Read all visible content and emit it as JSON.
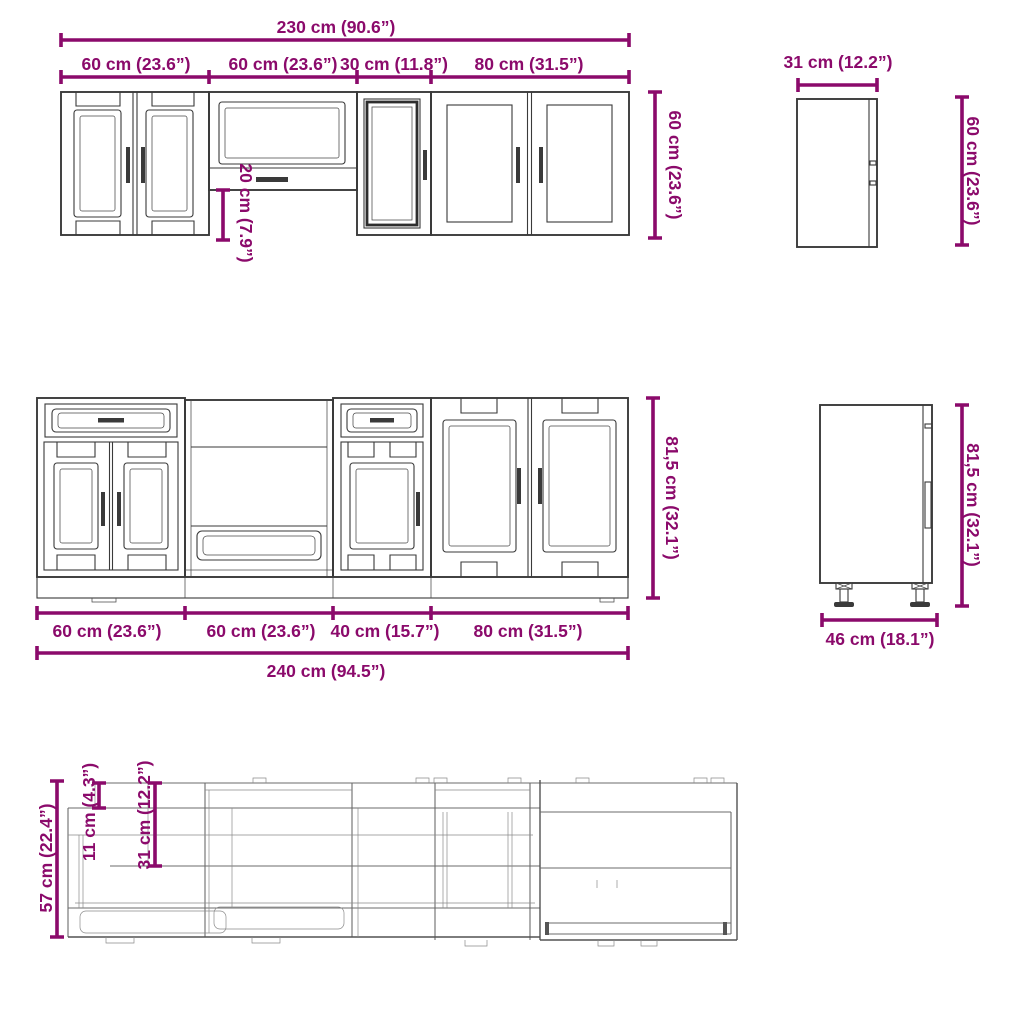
{
  "colors": {
    "dimension_accent": "#8B0A6B",
    "drawing_line": "#3a3a3a",
    "plan_line": "#6b6b6b",
    "background": "#ffffff"
  },
  "wall_run_front": {
    "total_width_label": "230 cm (90.6”)",
    "segment_labels": [
      "60 cm (23.6”)",
      "60 cm (23.6”)",
      "30 cm (11.8”)",
      "80 cm (31.5”)"
    ],
    "height_label": "60 cm (23.6”)",
    "hood_clearance_label": "20 cm (7.9”)"
  },
  "wall_cabinet_side": {
    "depth_label": "31 cm (12.2”)",
    "height_label": "60 cm (23.6”)"
  },
  "base_run_front": {
    "segment_labels": [
      "60 cm (23.6”)",
      "60 cm (23.6”)",
      "40 cm (15.7”)",
      "80 cm (31.5”)"
    ],
    "total_width_label": "240 cm (94.5”)",
    "height_label": "81,5 cm (32.1”)"
  },
  "base_cabinet_side": {
    "depth_label": "46 cm (18.1”)",
    "height_label": "81,5 cm (32.1”)"
  },
  "plan_view": {
    "total_depth_label": "57 cm (22.4”)",
    "upper_offset_label": "11 cm (4.3”)",
    "wall_depth_label": "31 cm (12.2”)"
  }
}
